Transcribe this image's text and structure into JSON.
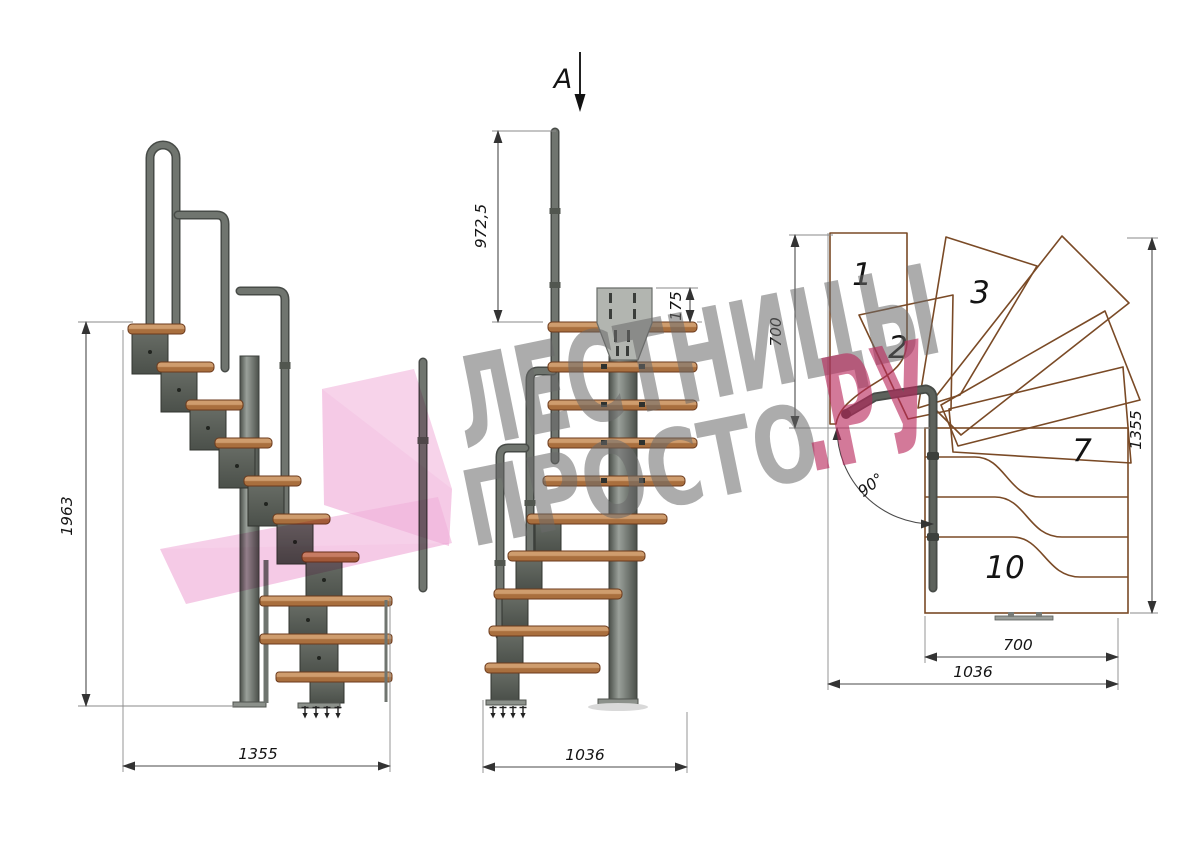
{
  "drawing": {
    "section_label": "A",
    "side_view": {
      "height_mm": "1963",
      "length_mm": "1355"
    },
    "front_view": {
      "handrail_height_mm": "972,5",
      "bracket_height_mm": "175",
      "width_mm": "1036"
    },
    "plan_view": {
      "entry_depth_mm": "700",
      "length_mm": "1355",
      "flight_width_mm": "700",
      "total_width_mm": "1036",
      "turn_angle": "90°",
      "tread_numbers": {
        "n1": "1",
        "n2": "2",
        "n3": "3",
        "n7": "7",
        "n10": "10"
      }
    }
  },
  "watermark": {
    "line1": "ЛЕСТНИЦЫ",
    "line2": "ПРОСТО",
    "accent": ".РУ"
  },
  "colors": {
    "wood_top": "#cf9d6e",
    "wood_side": "#a96f3e",
    "wood_outline": "#6b3a1c",
    "plan_wood_light": "#d2a173",
    "plan_wood_dark": "#b4805a",
    "plan_outline": "#7a4a26",
    "metal_light": "#9aa09a",
    "metal": "#666b64",
    "metal_dark": "#4b504a",
    "rail": "#70756f",
    "plate": "#b2b5b0",
    "dim_line": "#4a4a4a",
    "text": "#141414",
    "watermark_gray": "#6a6a6a",
    "watermark_pink": "#b9285c",
    "logo_pink": "#ec9ed2"
  }
}
